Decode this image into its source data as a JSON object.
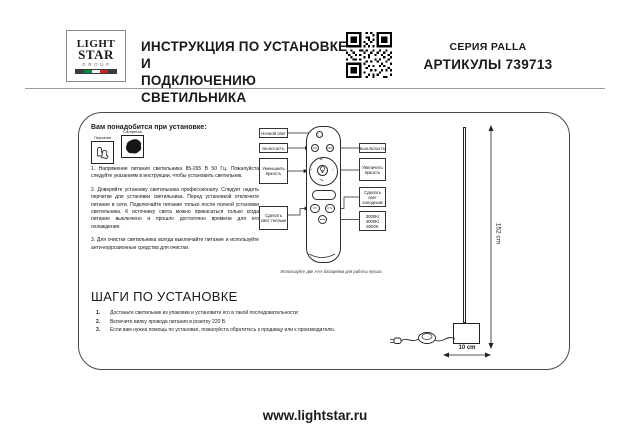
{
  "header": {
    "logo": {
      "word1": "LIGHT",
      "word2": "STAR",
      "word3": "GROUP"
    },
    "title_line1": "ИНСТРУКЦИЯ ПО УСТАНОВКЕ И",
    "title_line2": "ПОДКЛЮЧЕНИЮ СВЕТИЛЬНИКА",
    "series": "СЕРИЯ PALLA",
    "articles": "АРТИКУЛЫ 739713"
  },
  "instructions": {
    "tools_title": "Вам понадобится при установке:",
    "tools": [
      {
        "label": "Перчатки",
        "icon": "gloves-icon"
      },
      {
        "label": "Салфетка",
        "icon": "cloth-icon"
      }
    ],
    "paragraphs": [
      "1. Напряжение питания светильника 85-265 В 50 Гц. Пожалуйста следуйте указаниям в инструкции, чтобы установить светильник.",
      "2. Доверяйте установку светильника профессионалу. Следует надеть перчатки для установки светильника. Перед установкой отключите питание в сети. Подключайте питание только после полной установки светильника. К источнику света можно прикасаться только когда питание выключено и прошло достаточно времени для его охлаждения.",
      "3. Для очистки светильника всегда выключайте питание и используйте анти-коррозионные средства для очистки."
    ]
  },
  "steps": {
    "title": "ШАГИ ПО УСТАНОВКЕ",
    "items": [
      {
        "num": "1.",
        "text": "Достаньте светильник из упаковки и установите его в такой последовательности:"
      },
      {
        "num": "2.",
        "text": "Включите вилку провода питания в розетку 220 В."
      },
      {
        "num": "3.",
        "text": "Если вам нужна помощь по установке, пожалуйста обратитесь к продавцу или к производителю."
      }
    ]
  },
  "remote": {
    "buttons": {
      "on": "ON",
      "off": "OFF",
      "ct_minus": "CT-",
      "ct_plus": "CT+"
    },
    "labels_left": [
      "Ночной свет",
      "ВКЛЮЧИТЬ",
      "Уменьшить яркость",
      "Сделать свет теплым"
    ],
    "labels_right": [
      "ВЫКЛЮЧИТЬ",
      "Увеличить яркость",
      "Сделать свет холодным",
      "3000K/ 4000K/ 6000K"
    ],
    "caption": "Используйте две ААА батарейки для работы пульта"
  },
  "lamp": {
    "height_label": "152 cm",
    "width_label": "10 cm"
  },
  "footer": {
    "site": "www.lightstar.ru"
  },
  "colors": {
    "flag_green": "#008C45",
    "flag_white": "#f2f2f2",
    "flag_red": "#CD212A",
    "ink": "#1a1a1a"
  }
}
